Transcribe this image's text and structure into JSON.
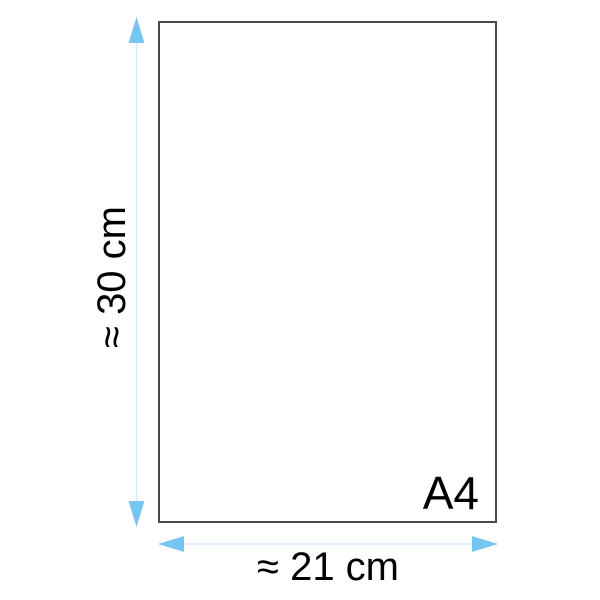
{
  "diagram": {
    "paper_label": "A4",
    "height_label": "≈ 30 cm",
    "width_label": "≈ 21 cm",
    "colors": {
      "arrow_head": "#76c5f1",
      "arrow_line": "#cfe8fa",
      "paper_border": "#4a4a4a",
      "label_text": "#000000",
      "background": "#ffffff"
    }
  }
}
